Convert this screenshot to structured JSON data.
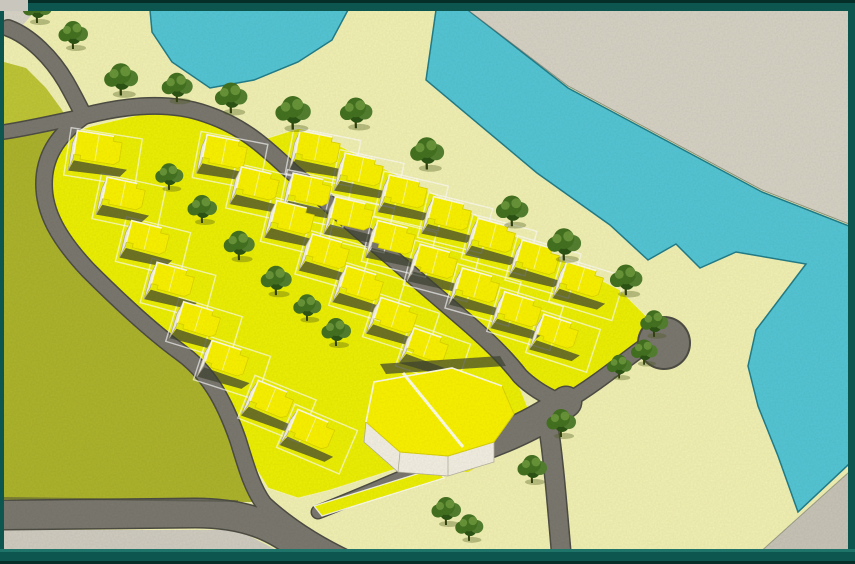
{
  "meta": {
    "title": "Aerial site-plan rendering of coastal housing development",
    "image_type": "architectural-rendering",
    "visible_text": ""
  },
  "canvas": {
    "w": 855,
    "h": 564
  },
  "colors": {
    "frame_teal": "#0c564f",
    "frame_dark": "#062e29",
    "frame_light": "#1e7468",
    "corner_notch": "#c9c6bd",
    "cream": "#f2f1b3",
    "cream_light": "#f6f5c2",
    "water": "#55c6d4",
    "water_edge": "#237e8a",
    "far_bank": "#d6d2c4",
    "far_bank_edge": "#5f6a60",
    "gray_corner": "#c8c4b7",
    "bottom_strip": "#d0ccc0",
    "field_main": "#adb42c",
    "field_light": "#bfc636",
    "road": "#7b786f",
    "road_dark": "#4e4e45",
    "band": "#edf004",
    "band_edge": "#fdfdef",
    "roof": "#faf200",
    "roof_shade": "#ddd400",
    "roof_highlight": "#fffdf0",
    "wall": "#f3efe2",
    "wall_edge": "#b5b1a0",
    "shadow": "#3e4431",
    "tree_dark": "#2d5515",
    "tree_mid": "#447221",
    "tree_mid2": "#548030",
    "tree_light": "#699539",
    "trunk": "#31420f",
    "tree_ground": "#4e5b1c",
    "corner_light": "#d8d5c8"
  },
  "scene": {
    "background": {
      "x": 4,
      "y": 10,
      "w": 845,
      "h": 541
    },
    "corner_light_poly": "4,10 36,10 22,26 4,32",
    "water": {
      "bay": "150,10 348,10 332,40 298,62 254,80 210,88 172,62 152,32",
      "canal": "436,10 468,10 568,88 762,192 849,226 849,464 798,512 778,456 758,406 748,366 756,330 806,264 736,252 700,268 676,244 648,260 610,225 537,173 426,80"
    },
    "far_bank": "468,10 849,10 849,224 762,190 568,86",
    "gray_corner": "758,554 849,472 849,554",
    "bottom_strip": "4,530 238,530 284,554 4,554",
    "field": {
      "upper": "4,62 26,68 46,88 62,110 66,118 4,124",
      "main": "4,140 76,126 54,142 44,172 46,208 66,246 96,284 130,316 164,344 192,366 214,396 232,444 246,486 252,502 4,500"
    },
    "bands": {
      "left": "92,126 150,112 210,118 258,144 300,182 350,228 400,272 455,318 505,362 520,380 500,416 462,444 430,458 330,490 298,498 268,488 252,462 238,430 210,386 178,354 140,322 98,284 62,238 46,196 48,158 66,134",
      "right": "268,138 300,128 340,146 620,290 650,320 640,352 598,380 556,398 530,378 470,322 388,252 306,182 270,152"
    },
    "big_building": {
      "apron": "352,380 452,358 516,380 530,414 504,452 468,472 418,470 356,436 344,404",
      "shadow": "380,364 500,356 506,366 386,374",
      "wall": "366,422 400,452 448,456 494,442 494,462 448,476 398,472 364,442",
      "facets": [
        [
          400,
          452,
          398,
          472
        ],
        [
          448,
          456,
          448,
          476
        ]
      ],
      "roof": "374,382 452,368 502,386 514,414 494,442 448,456 400,452 366,422",
      "divider": [
        403,
        373,
        463,
        447
      ],
      "highlight": "M 366,422 L 374,382 L 452,368 L 502,386"
    },
    "roads": [
      {
        "name": "road-entry",
        "d": "M 8,28 C 30,36 52,58 66,82 C 74,96 80,108 84,116",
        "w": 15
      },
      {
        "name": "road-stub-left",
        "d": "M 4,132 C 30,128 56,122 84,116",
        "w": 13
      },
      {
        "name": "road-central",
        "d": "M 84,116 C 130,104 172,102 206,114 C 242,126 262,144 292,172 L 462,318 C 490,342 506,358 520,376 C 532,388 546,396 560,402",
        "w": 15
      },
      {
        "name": "road-loop-left",
        "d": "M 84,116 C 56,136 44,158 44,184 C 44,212 58,238 88,270 C 118,300 150,330 180,352 C 208,372 224,400 238,440 C 246,466 252,488 264,504",
        "w": 15
      },
      {
        "name": "road-bottom-left",
        "d": "M 4,515 L 195,513 C 245,513 276,526 304,550 C 312,557 318,562 322,564",
        "w": 28
      },
      {
        "name": "road-fork-lower",
        "d": "M 264,504 C 290,528 320,546 350,560",
        "w": 15
      },
      {
        "name": "road-fork-upper",
        "d": "M 318,512 C 370,492 420,468 468,452",
        "w": 12
      },
      {
        "name": "road-plaza",
        "d": "M 462,452 C 505,438 540,422 566,402",
        "w": 30
      },
      {
        "name": "road-south-exit",
        "d": "M 548,424 C 554,462 558,516 562,562",
        "w": 18
      },
      {
        "name": "road-to-culdesac",
        "d": "M 566,402 C 596,384 620,364 642,348",
        "w": 14
      }
    ],
    "culdesac": {
      "cx": 664,
      "cy": 343,
      "r": 25
    },
    "median_island": "314,506 436,468 444,478 322,516",
    "field_edge_line": "M 4,498 L 238,501",
    "houses": [
      {
        "x": 98,
        "y": 148,
        "rot": 9,
        "w": 46,
        "h": 28
      },
      {
        "x": 124,
        "y": 194,
        "rot": 12,
        "w": 40,
        "h": 26
      },
      {
        "x": 148,
        "y": 238,
        "rot": 14,
        "w": 40,
        "h": 26
      },
      {
        "x": 173,
        "y": 280,
        "rot": 15,
        "w": 40,
        "h": 26
      },
      {
        "x": 199,
        "y": 320,
        "rot": 17,
        "w": 40,
        "h": 26
      },
      {
        "x": 227,
        "y": 359,
        "rot": 18,
        "w": 40,
        "h": 26
      },
      {
        "x": 272,
        "y": 400,
        "rot": 22,
        "w": 40,
        "h": 26
      },
      {
        "x": 312,
        "y": 430,
        "rot": 23,
        "w": 42,
        "h": 27
      },
      {
        "x": 225,
        "y": 152,
        "rot": 11,
        "w": 42,
        "h": 27
      },
      {
        "x": 258,
        "y": 184,
        "rot": 13,
        "w": 40,
        "h": 26
      },
      {
        "x": 293,
        "y": 218,
        "rot": 14,
        "w": 40,
        "h": 26
      },
      {
        "x": 328,
        "y": 252,
        "rot": 16,
        "w": 40,
        "h": 26
      },
      {
        "x": 362,
        "y": 284,
        "rot": 17,
        "w": 40,
        "h": 26
      },
      {
        "x": 396,
        "y": 316,
        "rot": 18,
        "w": 40,
        "h": 26
      },
      {
        "x": 428,
        "y": 346,
        "rot": 19,
        "w": 38,
        "h": 25
      },
      {
        "x": 310,
        "y": 190,
        "rot": 12,
        "w": 40,
        "h": 26
      },
      {
        "x": 352,
        "y": 214,
        "rot": 13,
        "w": 40,
        "h": 26
      },
      {
        "x": 394,
        "y": 238,
        "rot": 14,
        "w": 40,
        "h": 26
      },
      {
        "x": 436,
        "y": 262,
        "rot": 15,
        "w": 40,
        "h": 26
      },
      {
        "x": 478,
        "y": 286,
        "rot": 16,
        "w": 40,
        "h": 26
      },
      {
        "x": 520,
        "y": 310,
        "rot": 17,
        "w": 40,
        "h": 26
      },
      {
        "x": 558,
        "y": 332,
        "rot": 18,
        "w": 38,
        "h": 25
      },
      {
        "x": 318,
        "y": 148,
        "rot": 11,
        "w": 42,
        "h": 27
      },
      {
        "x": 362,
        "y": 170,
        "rot": 12,
        "w": 40,
        "h": 26
      },
      {
        "x": 406,
        "y": 192,
        "rot": 13,
        "w": 40,
        "h": 26
      },
      {
        "x": 450,
        "y": 214,
        "rot": 14,
        "w": 40,
        "h": 26
      },
      {
        "x": 494,
        "y": 236,
        "rot": 15,
        "w": 40,
        "h": 26
      },
      {
        "x": 538,
        "y": 258,
        "rot": 16,
        "w": 40,
        "h": 26
      },
      {
        "x": 582,
        "y": 280,
        "rot": 17,
        "w": 40,
        "h": 26
      }
    ],
    "trees": [
      {
        "x": 38,
        "y": 20,
        "s": 1.0
      },
      {
        "x": 74,
        "y": 46,
        "s": 1.0
      },
      {
        "x": 122,
        "y": 92,
        "s": 1.15
      },
      {
        "x": 178,
        "y": 99,
        "s": 1.05
      },
      {
        "x": 232,
        "y": 110,
        "s": 1.1
      },
      {
        "x": 294,
        "y": 126,
        "s": 1.2
      },
      {
        "x": 357,
        "y": 125,
        "s": 1.1
      },
      {
        "x": 428,
        "y": 166,
        "s": 1.15
      },
      {
        "x": 170,
        "y": 187,
        "s": 0.95
      },
      {
        "x": 203,
        "y": 220,
        "s": 1.0
      },
      {
        "x": 240,
        "y": 257,
        "s": 1.05
      },
      {
        "x": 277,
        "y": 292,
        "s": 1.05
      },
      {
        "x": 308,
        "y": 318,
        "s": 0.95
      },
      {
        "x": 337,
        "y": 343,
        "s": 1.0
      },
      {
        "x": 513,
        "y": 223,
        "s": 1.1
      },
      {
        "x": 565,
        "y": 257,
        "s": 1.15
      },
      {
        "x": 627,
        "y": 292,
        "s": 1.1
      },
      {
        "x": 655,
        "y": 334,
        "s": 0.95
      },
      {
        "x": 645,
        "y": 362,
        "s": 0.9
      },
      {
        "x": 620,
        "y": 376,
        "s": 0.85
      },
      {
        "x": 447,
        "y": 522,
        "s": 1.0
      },
      {
        "x": 470,
        "y": 538,
        "s": 0.95
      },
      {
        "x": 533,
        "y": 480,
        "s": 1.0
      },
      {
        "x": 562,
        "y": 434,
        "s": 1.0
      }
    ],
    "frame": {
      "top_dark": [
        0,
        0,
        855,
        3
      ],
      "top": [
        0,
        3,
        855,
        8
      ],
      "left": [
        0,
        0,
        4,
        564
      ],
      "right": [
        848,
        0,
        7,
        564
      ],
      "bottom_line": [
        0,
        549,
        855,
        3
      ],
      "bottom": [
        0,
        552,
        855,
        9
      ],
      "bottom_dark": [
        0,
        561,
        855,
        3
      ],
      "notch": [
        0,
        0,
        28,
        11
      ]
    }
  }
}
